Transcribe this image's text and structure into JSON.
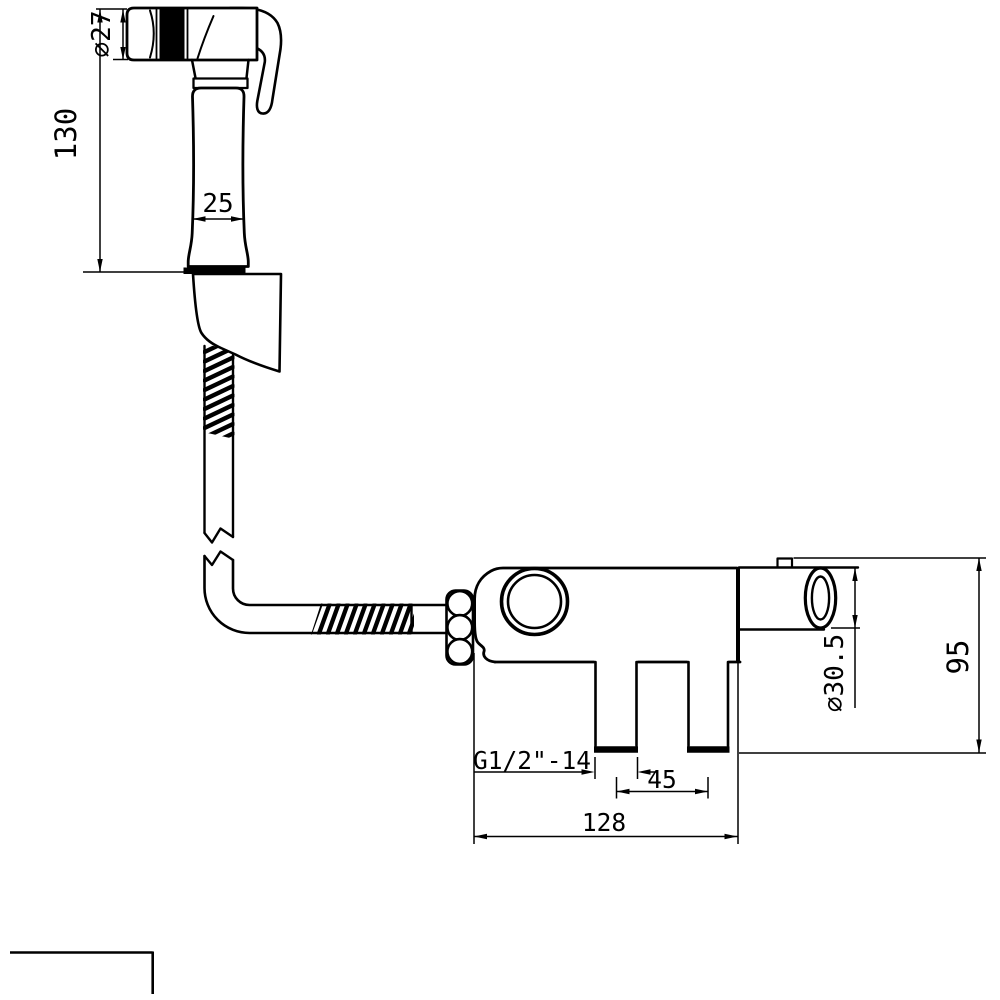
{
  "colors": {
    "line": "#000000",
    "background": "#ffffff"
  },
  "dimensions": {
    "sprayer_head_diameter": "⌀27",
    "sprayer_length": "130",
    "handle_width": "25",
    "inlet_thread": "G1/2\"-14",
    "inlet_spacing": "45",
    "valve_width": "128",
    "outlet_diameter": "⌀30.5",
    "valve_height": "95"
  }
}
